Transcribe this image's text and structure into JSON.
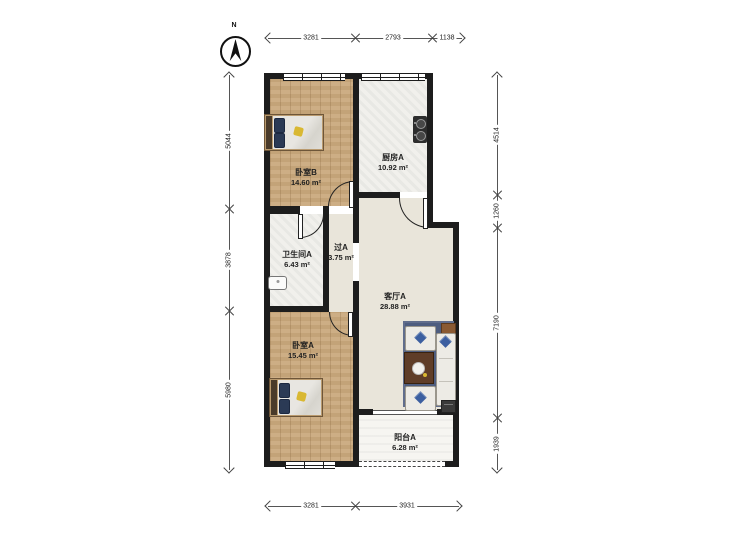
{
  "compass": {
    "label": "N"
  },
  "dimensions": {
    "top": [
      "3281",
      "2793",
      "1138"
    ],
    "bottom": [
      "3281",
      "3931"
    ],
    "left": [
      "5044",
      "3878",
      "5980"
    ],
    "right": [
      "4514",
      "1260",
      "7190",
      "1939"
    ]
  },
  "rooms": [
    {
      "name": "卧室B",
      "area": "14.60 m²"
    },
    {
      "name": "厨房A",
      "area": "10.92 m²"
    },
    {
      "name": "卫生间A",
      "area": "6.43 m²"
    },
    {
      "name": "过A",
      "area": "3.75 m²"
    },
    {
      "name": "客厅A",
      "area": "28.88 m²"
    },
    {
      "name": "卧室A",
      "area": "15.45 m²"
    },
    {
      "name": "阳台A",
      "area": "6.28 m²"
    }
  ],
  "colors": {
    "wall": "#1d1d1d",
    "wood_floor": "#c9a87c",
    "tile_floor": "#f1f0ec",
    "living_floor": "#e9e5da",
    "balcony_floor": "#f6f5f1",
    "rug": "#4e5d7f",
    "sofa": "#edebe5",
    "pillow_accent": "#3c5fa0",
    "bed_pillow": "#2b3a55",
    "bed_accent": "#d9b832",
    "table_wood": "#5f3d28",
    "dimension_text": "#222222"
  }
}
